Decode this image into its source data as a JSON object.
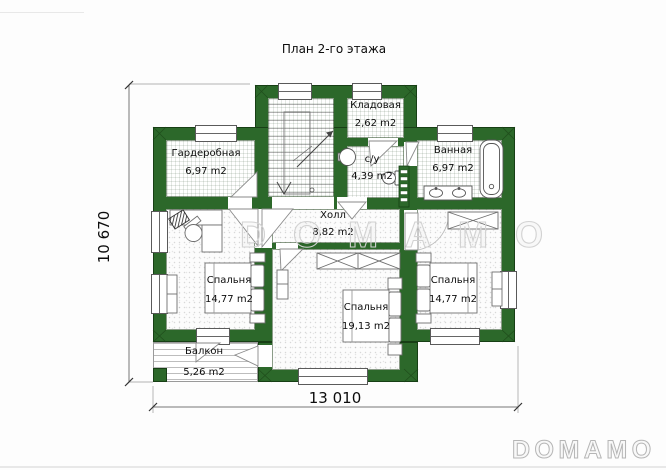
{
  "title": "План 2-го этажа",
  "rooms": [
    {
      "id": "wardrobe",
      "name": "Гардеробная",
      "area": "6,97 m2"
    },
    {
      "id": "storage",
      "name": "Кладовая",
      "area": "2,62 m2"
    },
    {
      "id": "wc",
      "name": "с/у",
      "area": "4,39 m2"
    },
    {
      "id": "bathroom",
      "name": "Ванная",
      "area": "6,97 m2"
    },
    {
      "id": "hall",
      "name": "Холл",
      "area": "8,82 m2"
    },
    {
      "id": "bedroom-left",
      "name": "Спальня",
      "area": "14,77 m2"
    },
    {
      "id": "bedroom-middle",
      "name": "Спальня",
      "area": "19,13 m2"
    },
    {
      "id": "bedroom-right",
      "name": "Спальня",
      "area": "14,77 m2"
    },
    {
      "id": "balcony",
      "name": "Балкон",
      "area": "5,26 m2"
    }
  ],
  "dimensions": {
    "width_label": "13 010",
    "height_label": "10 670"
  },
  "watermark": "DOMAMO",
  "brand_logo": "DOMAMO",
  "colors": {
    "wall_green": "#2c682a",
    "wall_edge": "#173f15",
    "dim_line": "#777777"
  }
}
